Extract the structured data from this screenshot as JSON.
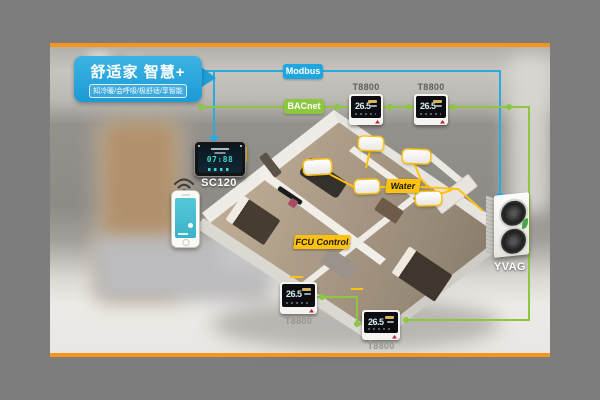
{
  "callout": {
    "title": "舒适家 智慧+",
    "tagline": "知冷暖/会呼吸/极舒适/享智能"
  },
  "bus_labels": {
    "modbus": "Modbus",
    "bacnet": "BACnet"
  },
  "pipe_labels": {
    "water": "Water",
    "fcu_control": "FCU Control"
  },
  "controller": {
    "model": "SC120",
    "display_time": "07:88"
  },
  "outdoor_unit": {
    "model": "YVAG"
  },
  "thermostats": [
    {
      "position": "top-left",
      "model": "T8800",
      "temp": "26.5"
    },
    {
      "position": "top-right",
      "model": "T8800",
      "temp": "26.5"
    },
    {
      "position": "bottom-left",
      "model": "T8800",
      "temp": "26.5"
    },
    {
      "position": "bottom-right",
      "model": "T8800",
      "temp": "26.5"
    }
  ],
  "icons": {
    "wifi": "wifi-icon",
    "smartphone": "smartphone",
    "leaf": "leaf-icon"
  },
  "colors": {
    "modbus_line": "#29abe2",
    "bacnet_line": "#8dc63f",
    "pipe_yellow": "#ffc20e",
    "frame_orange": "#f7941d",
    "callout_blue": "#1fa0dc",
    "matte_gray": "#7d7d7d"
  }
}
